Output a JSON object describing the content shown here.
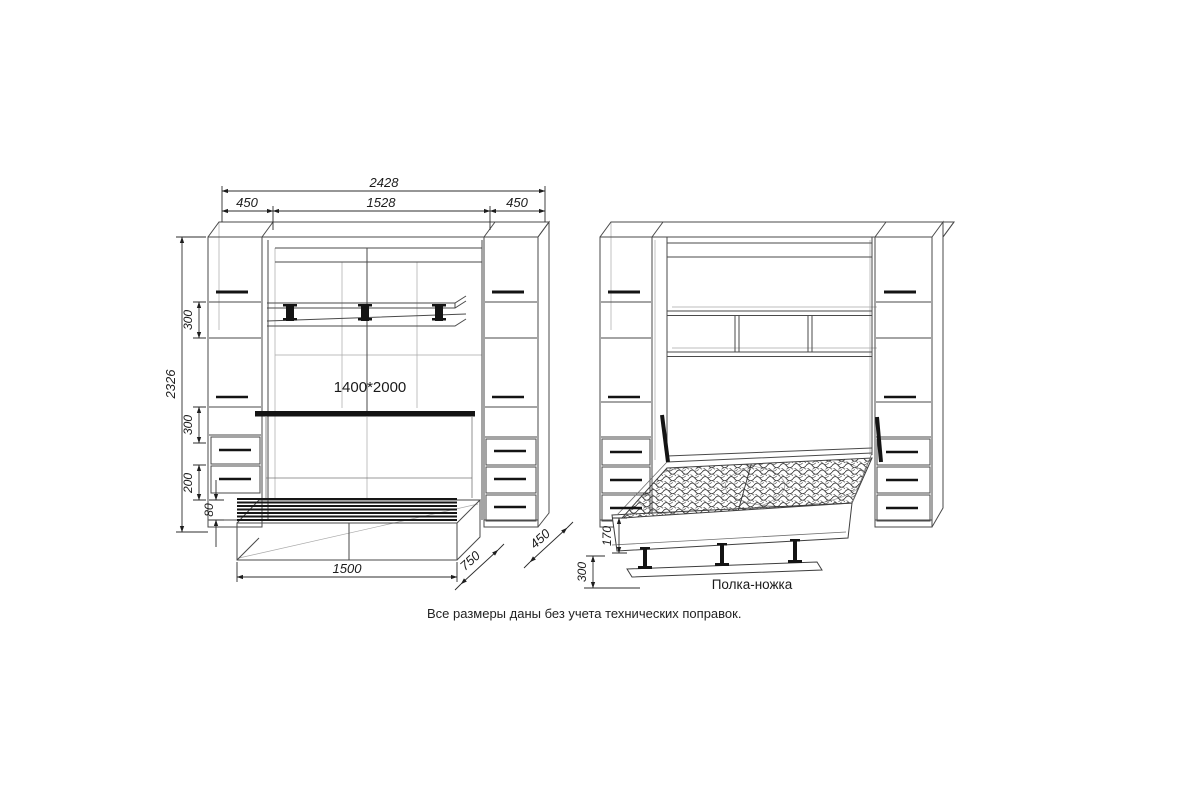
{
  "note": "Все размеры даны без учета технических поправок.",
  "closed_view": {
    "bed_size_label": "1400*2000",
    "dims": {
      "total_width": "2428",
      "left_cabinet_width": "450",
      "center_width": "1528",
      "right_cabinet_width": "450",
      "total_height": "2326",
      "upper_shelf_spacing": "300",
      "lower_shelf_spacing": "300",
      "drawer_section_height": "200",
      "plinth_height": "80",
      "bench_length": "1500",
      "bench_depth": "750",
      "cabinet_depth": "450"
    }
  },
  "open_view": {
    "shelf_leg_label": "Полка-ножка",
    "dims": {
      "bed_frame_height": "170",
      "floor_clearance": "300"
    }
  },
  "colors": {
    "ink": "#4a4a4a",
    "thick_ink": "#141414",
    "background": "#ffffff"
  }
}
